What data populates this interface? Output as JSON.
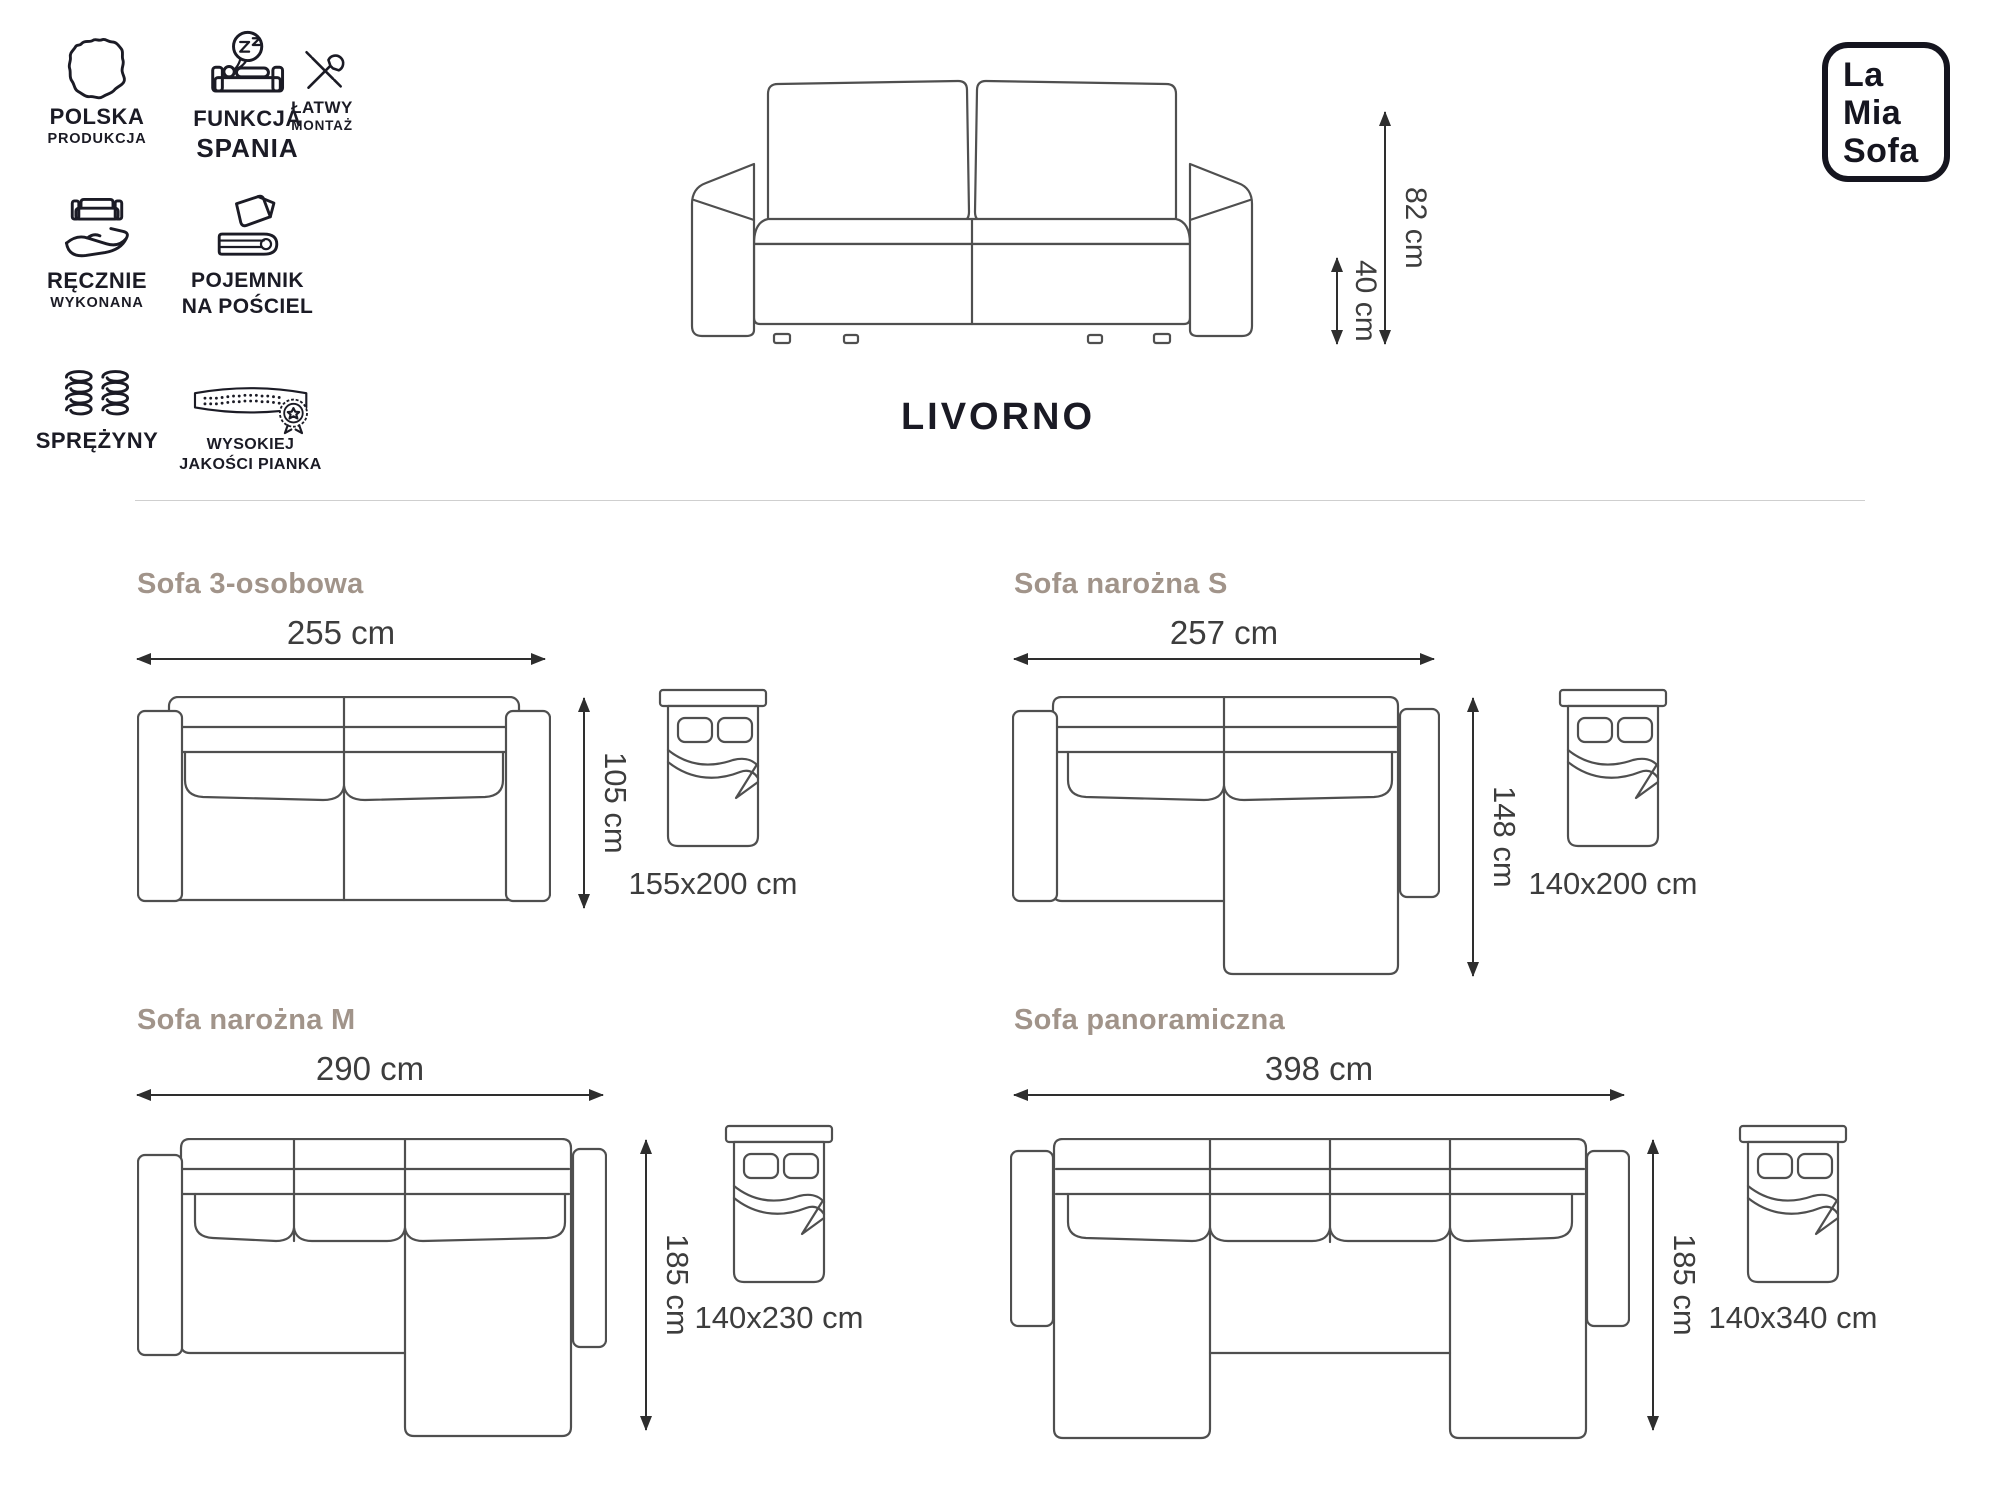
{
  "colors": {
    "ink": "#1b1b25",
    "drawing_line": "#4f4f4f",
    "dimension_text": "#3d3d3d",
    "accent_heading": "#a1948a",
    "arrow": "#2e2e2e",
    "divider": "#cfcfcf"
  },
  "logo": {
    "line1": "La",
    "line2": "Mia",
    "line3": "Sofa"
  },
  "product": {
    "name": "LIVORNO",
    "overall_height": "82 cm",
    "seat_height": "40 cm"
  },
  "features": [
    {
      "name": "polska-produkcja",
      "line1": "POLSKA",
      "line2": "PRODUKCJA"
    },
    {
      "name": "funkcja-spania",
      "line1": "FUNKCJA",
      "line2": "SPANIA"
    },
    {
      "name": "latwy-montaz",
      "line1": "ŁATWY",
      "line2": "MONTAŻ"
    },
    {
      "name": "recznie-wykonana",
      "line1": "RĘCZNIE",
      "line2": "WYKONANA"
    },
    {
      "name": "pojemnik-na-posciel",
      "line1": "POJEMNIK",
      "line2": "NA POŚCIEL"
    },
    {
      "name": "sprezyny",
      "line1": "SPRĘŻYNY",
      "line2": ""
    },
    {
      "name": "wysokiej-jakosci-pianka",
      "line1": "WYSOKIEJ",
      "line2": "JAKOŚCI PIANKA"
    }
  ],
  "variants": [
    {
      "title": "Sofa 3-osobowa",
      "width": "255 cm",
      "depth": "105 cm",
      "bed": "155x200 cm"
    },
    {
      "title": "Sofa narożna S",
      "width": "257 cm",
      "depth": "148 cm",
      "bed": "140x200 cm"
    },
    {
      "title": "Sofa narożna M",
      "width": "290 cm",
      "depth": "185 cm",
      "bed": "140x230 cm"
    },
    {
      "title": "Sofa panoramiczna",
      "width": "398 cm",
      "depth": "185 cm",
      "bed": "140x340 cm"
    }
  ]
}
